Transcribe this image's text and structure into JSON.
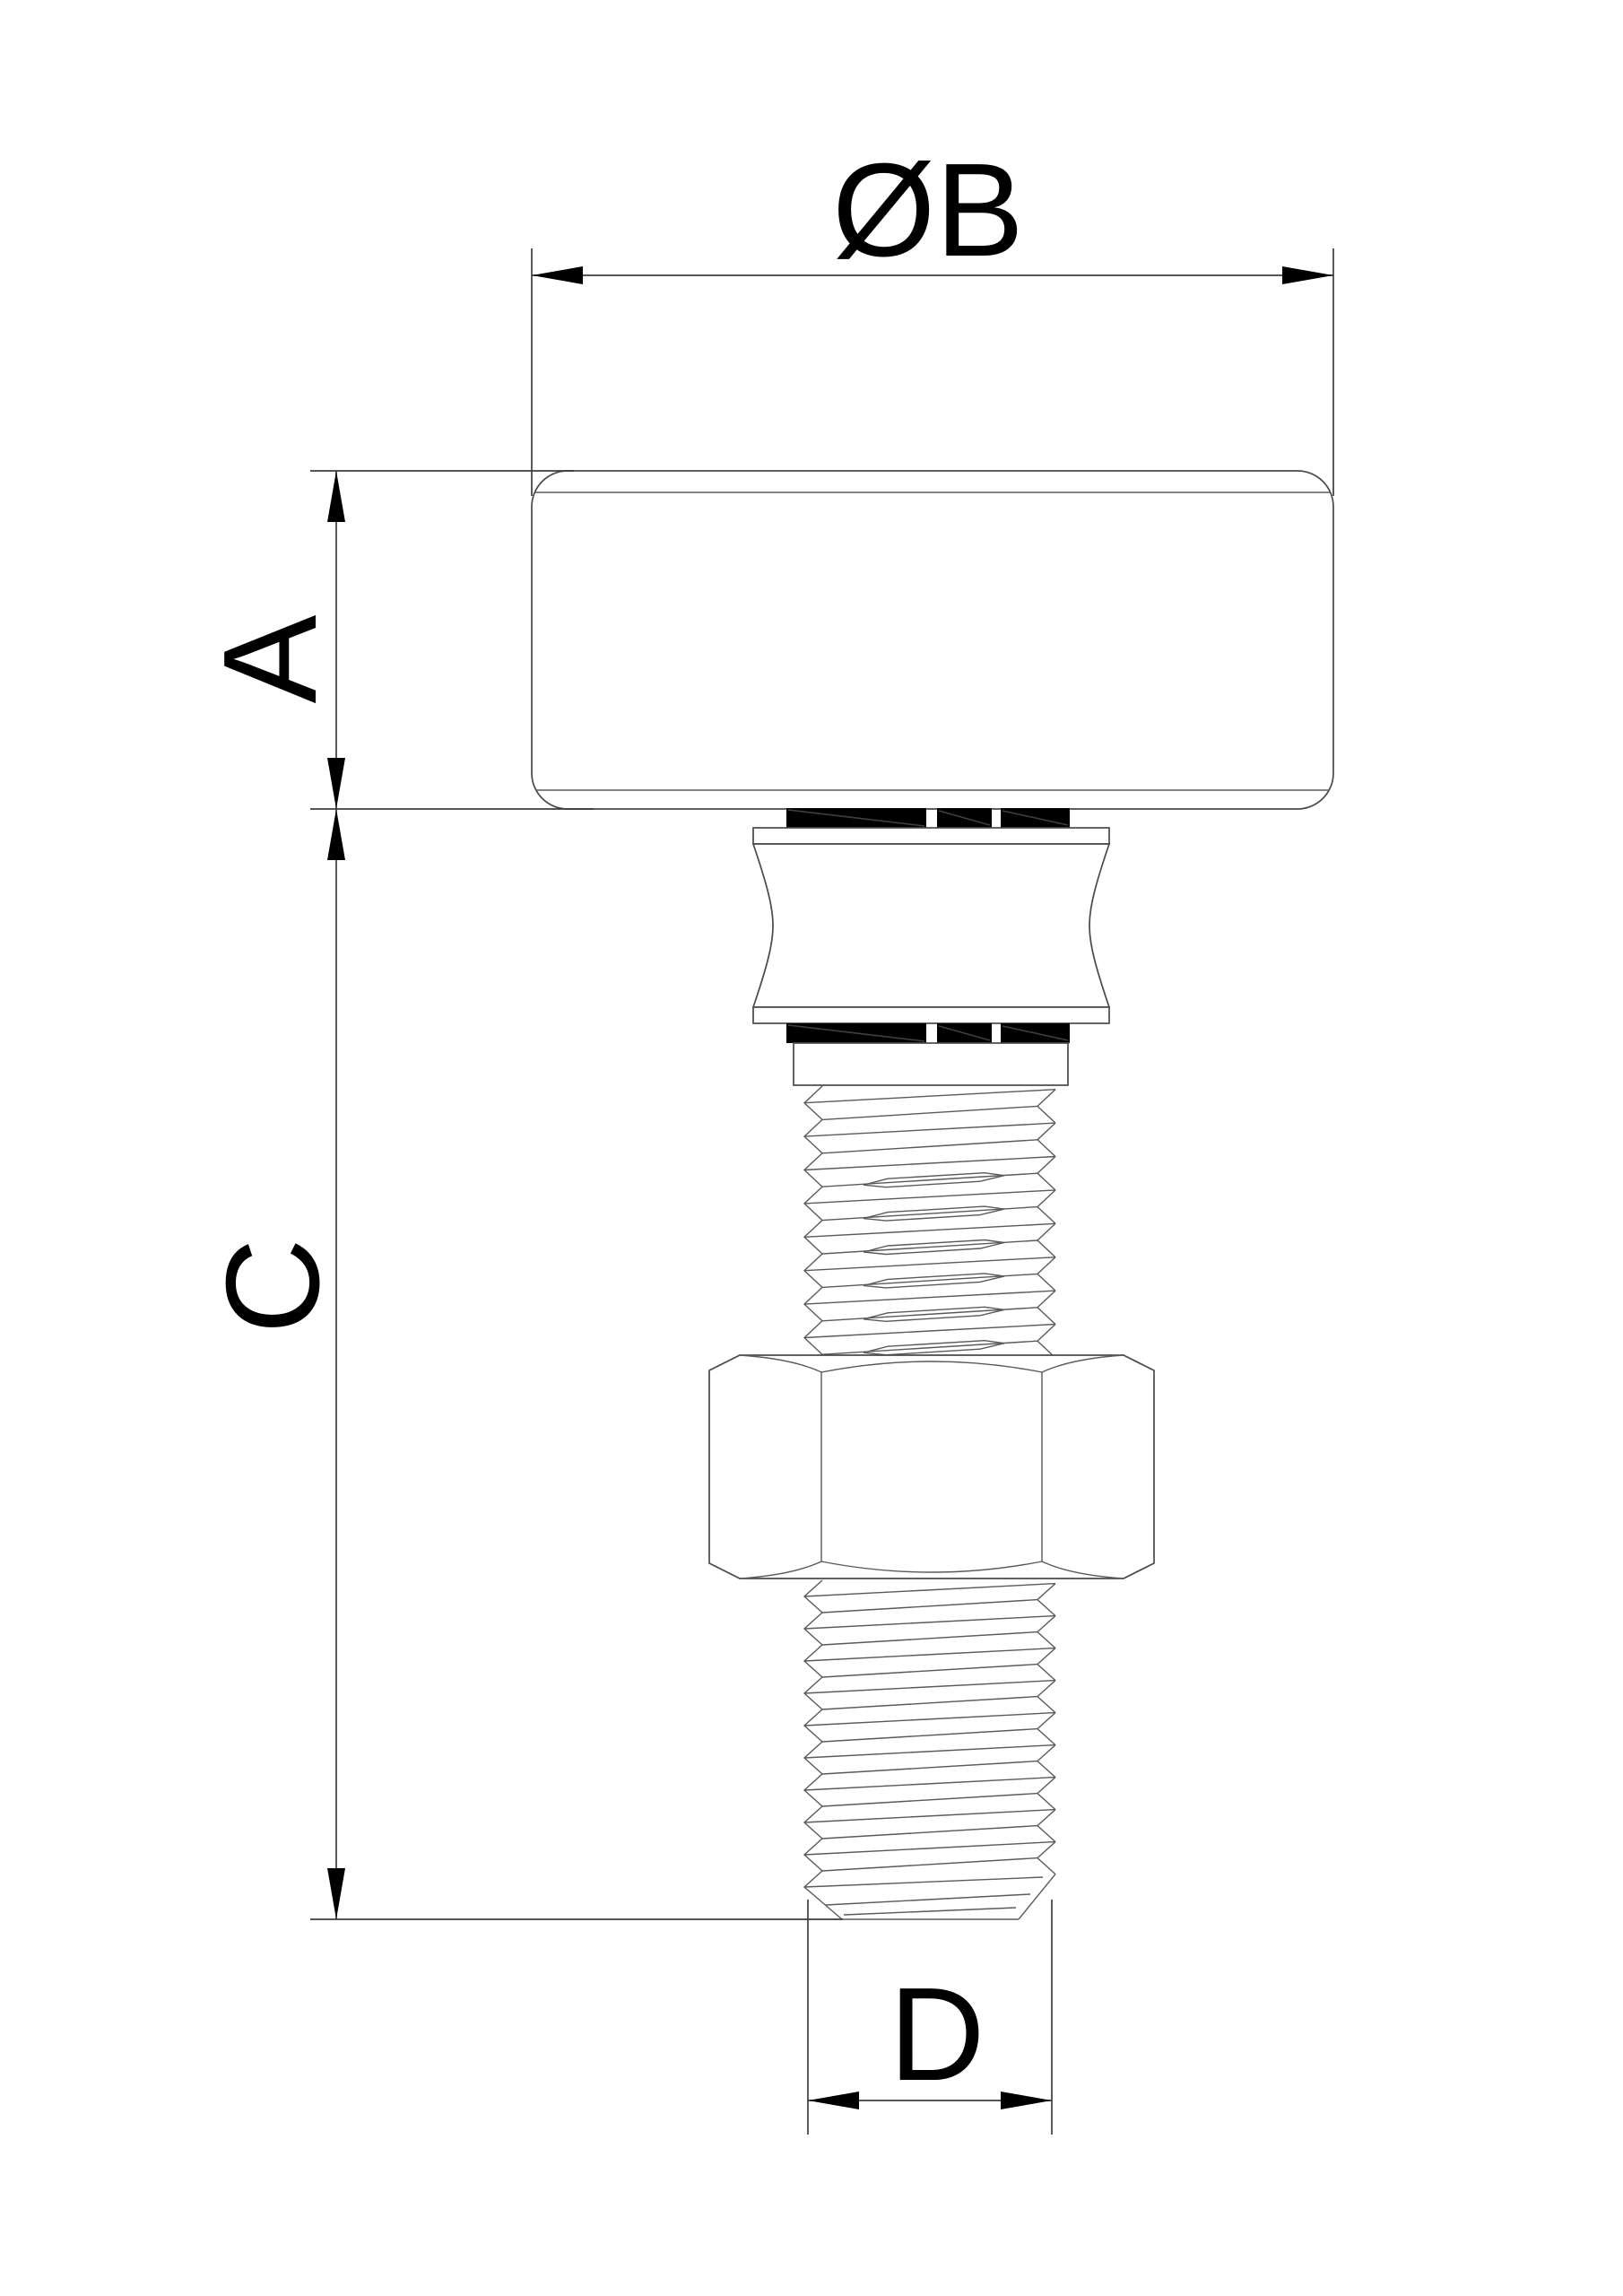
{
  "drawing": {
    "type": "engineering-dimension-drawing",
    "part": "roller-bolt-assembly",
    "dimensions": {
      "roller_diameter": {
        "label": "ØB"
      },
      "roller_height": {
        "label": "A"
      },
      "shaft_length": {
        "label": "C"
      },
      "thread_diameter": {
        "label": "D"
      }
    },
    "colors": {
      "background": "#ffffff",
      "outline": "#4a4a4a",
      "dimension_line": "#3e3e3e",
      "text_and_arrows": "#000000",
      "seal_band": "#000000"
    }
  }
}
